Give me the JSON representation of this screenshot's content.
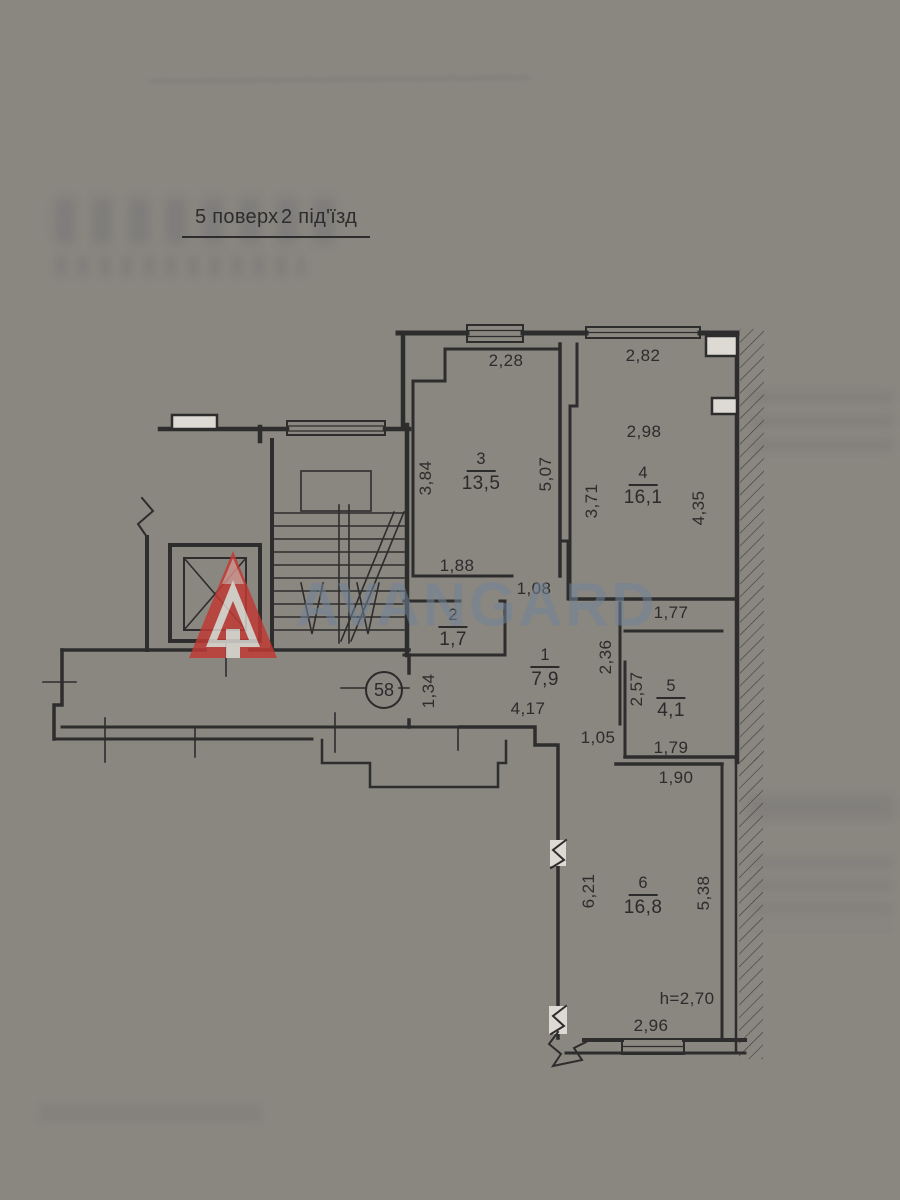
{
  "header": {
    "floor": "5 поверх",
    "entrance": "2 під'їзд"
  },
  "apartment": {
    "number": "58"
  },
  "watermark": {
    "brand": "AVANGARD"
  },
  "colors": {
    "ink": "#2d2d2d",
    "paper": "#ddd9d3",
    "logo_red": "#bf3a33",
    "watermark_blue": "#72849a"
  },
  "rooms": [
    {
      "number": "1",
      "area": "7,9",
      "x": 545,
      "y": 646
    },
    {
      "number": "2",
      "area": "1,7",
      "x": 453,
      "y": 606
    },
    {
      "number": "3",
      "area": "13,5",
      "x": 481,
      "y": 450
    },
    {
      "number": "4",
      "area": "16,1",
      "x": 643,
      "y": 464
    },
    {
      "number": "5",
      "area": "4,1",
      "x": 671,
      "y": 677
    },
    {
      "number": "6",
      "area": "16,8",
      "x": 643,
      "y": 874
    }
  ],
  "dimensions": [
    {
      "value": "2,28",
      "x": 506,
      "y": 361,
      "rot": 0
    },
    {
      "value": "2,82",
      "x": 643,
      "y": 356,
      "rot": 0
    },
    {
      "value": "2,98",
      "x": 644,
      "y": 432,
      "rot": 0
    },
    {
      "value": "3,84",
      "x": 426,
      "y": 478,
      "rot": -90
    },
    {
      "value": "5,07",
      "x": 546,
      "y": 474,
      "rot": -90
    },
    {
      "value": "3,71",
      "x": 592,
      "y": 501,
      "rot": -90
    },
    {
      "value": "4,35",
      "x": 699,
      "y": 508,
      "rot": -90
    },
    {
      "value": "1,88",
      "x": 457,
      "y": 566,
      "rot": 0
    },
    {
      "value": "1,08",
      "x": 534,
      "y": 589,
      "rot": 0
    },
    {
      "value": "1,77",
      "x": 671,
      "y": 613,
      "rot": 0
    },
    {
      "value": "2,36",
      "x": 606,
      "y": 657,
      "rot": -90
    },
    {
      "value": "2,57",
      "x": 637,
      "y": 689,
      "rot": -90
    },
    {
      "value": "1,34",
      "x": 429,
      "y": 691,
      "rot": -90
    },
    {
      "value": "4,17",
      "x": 528,
      "y": 709,
      "rot": 0
    },
    {
      "value": "1,05",
      "x": 598,
      "y": 738,
      "rot": 0
    },
    {
      "value": "1,79",
      "x": 671,
      "y": 748,
      "rot": 0
    },
    {
      "value": "1,90",
      "x": 676,
      "y": 778,
      "rot": 0
    },
    {
      "value": "6,21",
      "x": 589,
      "y": 891,
      "rot": -90
    },
    {
      "value": "5,38",
      "x": 704,
      "y": 893,
      "rot": -90
    },
    {
      "value": "h=2,70",
      "x": 687,
      "y": 999,
      "rot": 0
    },
    {
      "value": "2,96",
      "x": 651,
      "y": 1026,
      "rot": 0
    }
  ]
}
